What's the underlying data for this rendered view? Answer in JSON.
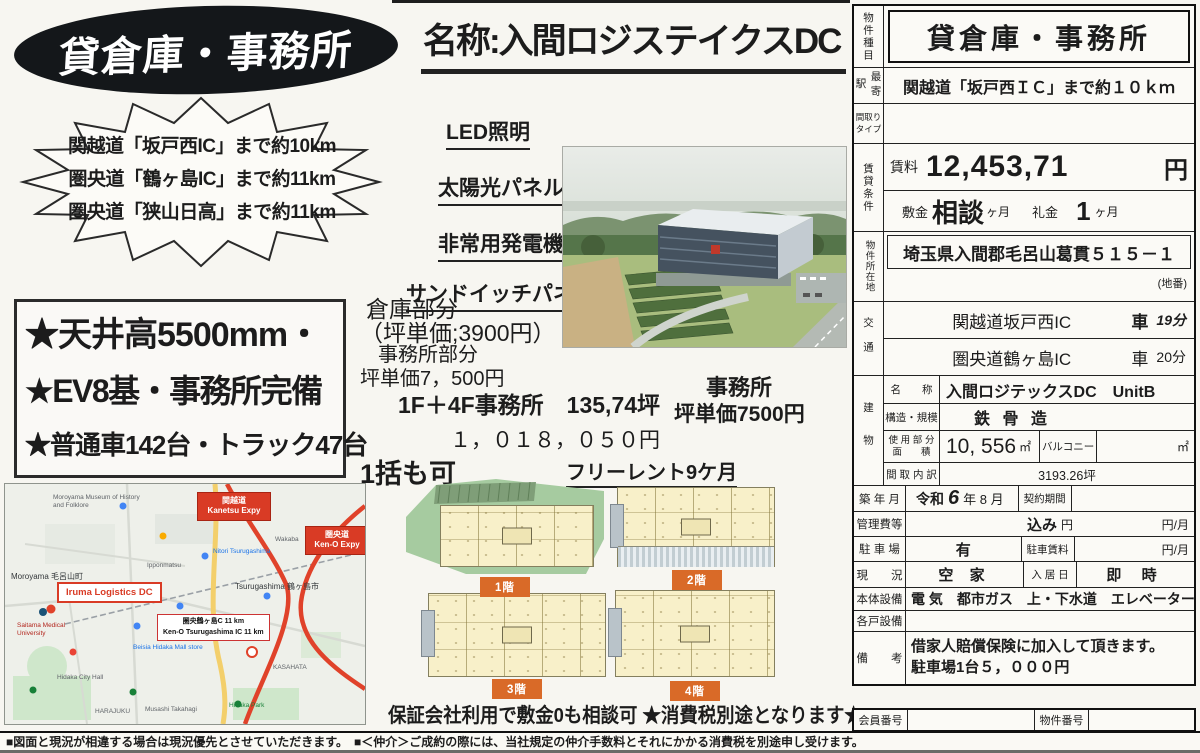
{
  "flyer": {
    "badge_title": "貸倉庫・事務所",
    "burst_lines": [
      "関越道「坂戸西IC」まで約10km",
      "圏央道「鶴ヶ島IC」まで約11km",
      "圏央道「狭山日高」まで約11km"
    ],
    "highlights": [
      "★天井高5500mm・",
      "★EV8基・事務所完備",
      "★普通車142台・トラック47台"
    ],
    "name_title": "名称:入間ロジステイクスDC",
    "features": [
      "LED照明",
      "太陽光パネル",
      "非常用発電機",
      "サンドイッチパネル"
    ],
    "warehouse_part": [
      "倉庫部分",
      "（坪単価;3900円）"
    ],
    "office_part": [
      "事務所部分",
      "坪単価7，500円",
      "1F＋4F事務所　135,74坪",
      "１，０１８，０５０円"
    ],
    "office_side": [
      "事務所",
      "坪単価7500円"
    ],
    "bulk_note": "1括も可",
    "free_rent": "フリーレント9ケ月",
    "floor_labels": [
      "1階",
      "2階",
      "3階",
      "4階"
    ],
    "guarantee_note": "保証会社利用で敷金0も相談可 ★消費税別途となります★"
  },
  "map": {
    "badge_kanetsu": [
      "関越道",
      "Kanetsu Expy"
    ],
    "badge_keno": [
      "圏央道",
      "Ken-O Expy"
    ],
    "property_marker": "Iruma Logistics DC",
    "distance_box": [
      "圏央鶴ヶ島C 11 km",
      "Ken-O Tsurugashima IC 11 km"
    ],
    "labels": [
      "Moroyama Museum of History and Folklore",
      "Moroyama 毛呂山町",
      "Saitama Medical University",
      "Ipponmatsu",
      "Wakaba",
      "Nitori Tsurugashima",
      "Tsurugashima 鶴ヶ島市",
      "Beisia Hidaka Mall store",
      "KASAHATA",
      "Hidaka Park",
      "HARAJUKU",
      "Musashi Takahagi",
      "Hidaka City Hall"
    ]
  },
  "table": {
    "property_type_label": "物件種目",
    "property_type": "貸倉庫・事務所",
    "station_label": "最寄駅",
    "station": "関越道「坂戸西ＩＣ」まで約１０ｋｍ",
    "madori_label": [
      "間取り",
      "タイプ"
    ],
    "rent_group_label": "賃貸条件",
    "rent_label": "賃料",
    "rent_value": "12,453,71",
    "rent_unit": "円",
    "deposit_label": "敷金",
    "deposit_value": "相談",
    "deposit_unit": "ヶ月",
    "key_money_label": "礼金",
    "key_money_value": "1",
    "key_money_unit": "ヶ月",
    "location_label": "物件所在地",
    "address": "埼玉県入間郡毛呂山葛貫５１５－１",
    "address_note": "(地番)",
    "access_label": "交通",
    "access1_name": "関越道坂戸西IC",
    "access1_mode": "車",
    "access1_time": "19分",
    "access2_name": "圏央道鶴ヶ島IC",
    "access2_mode": "車",
    "access2_time": "20分",
    "building_label": "建物",
    "name_label": "名　　称",
    "building_name": "入間ロジテックスDC　UnitB",
    "structure_label": "構造・規模",
    "structure": "鉄 骨 造",
    "area_label": [
      "使 用 部 分",
      "面　　積"
    ],
    "area_value": "10, 556",
    "area_unit": "㎡",
    "balcony_label": "バルコニー",
    "balcony_unit": "㎡",
    "layout_label": "間 取 内 訳",
    "layout_value": "3193.26坪",
    "built_label": "築 年 月",
    "built_era": "令和",
    "built_num": "6",
    "built_rest": "年 8 月",
    "contract_label": "契約期間",
    "mgmt_label": "管理費等",
    "mgmt_value": "込み",
    "mgmt_yen": "円",
    "mgmt_unit": "円/月",
    "parking_label": "駐 車 場",
    "parking_value": "有",
    "parking_fee_label": "駐車賃料",
    "parking_fee_unit": "円/月",
    "status_label": "現　　況",
    "status_value": "空 家",
    "movein_label": "入 居 日",
    "movein_value": "即 時",
    "facilities_label": "本体設備",
    "facilities": "電 気　都市ガス　上・下水道　エレベーター",
    "unit_facilities_label": "各戸設備",
    "remarks_label": "備　　考",
    "remarks": [
      "借家人賠償保険に加入して頂きます。",
      "駐車場1台５，０００円"
    ],
    "member_no_label": "会員番号",
    "property_no_label": "物件番号"
  },
  "footer": {
    "disclaimer": "■図面と現況が相違する場合は現況優先とさせていただきます。　■＜仲介＞ご成約の際には、当社規定の仲介手数料とそれにかかる消費税を別途申し受けます。"
  }
}
